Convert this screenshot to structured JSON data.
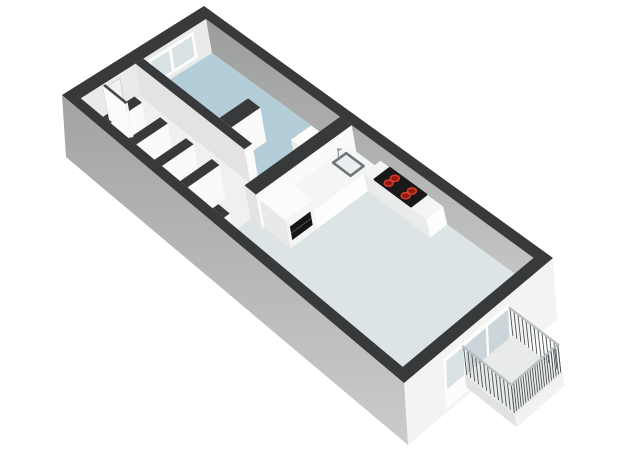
{
  "scene": {
    "type": "floorplan-3d",
    "canvas": {
      "width": 640,
      "height": 451,
      "background": "#ffffff"
    },
    "palette": {
      "wallTop": "#38393b",
      "wallFaceLit": "#fafaf9",
      "wallFaceShade": "#e3e3e1",
      "neWallTopShade": "#9b9d9d",
      "neWallBottomShade": "#c6c7c6",
      "nwWallFace": "#eaeae9",
      "extWallSW_dark": "#a2a3a3",
      "extWallSW_light": "#cbcbca",
      "extWallSE": "#f3f3f2",
      "floorBedroom": "#b3ced8",
      "floorHall": "#f0f0ee",
      "floorLiving": "#dde4e6",
      "floorBalcony": "#e9ebea",
      "glass": "#ccd5d9",
      "glassLight": "#d8e1e4",
      "frame": "#fcfcfc",
      "stoveTop": "#191919",
      "burnerFill": "#8f1a12",
      "burnerRing": "#d23a2c",
      "sinkRim": "#6f7579",
      "sinkBasin": "#eaeeee",
      "faucet": "#9aa0a2",
      "railPost": "#4e5254",
      "railTop": "#b9bec0",
      "cabinetTop": "#fbfbfa",
      "counterTop": "#f4f6f5",
      "ovenBlack": "#151515",
      "doorPanel": "#f1f1ef",
      "doorEdge": "#cfcfcd",
      "unitTop": "#fcfcfb"
    },
    "projection": {
      "corners": {
        "N": [
          204,
          6
        ],
        "E": [
          553,
          258
        ],
        "S": [
          404,
          383
        ],
        "W": [
          62,
          95
        ]
      },
      "floorDrop": [
        6,
        34
      ],
      "groundDrop": [
        4,
        62
      ],
      "exteriorThicknessA": 0.03,
      "exteriorThicknessB": 0.06
    },
    "rooms": [
      {
        "name": "bedroom",
        "floorColorKey": "floorBedroom",
        "rect": {
          "a1": 0.03,
          "a2": 0.448,
          "b1": 0.06,
          "b2": 0.555
        }
      },
      {
        "name": "hallway-with-closets",
        "floorColorKey": "floorHall",
        "rect": {
          "a1": 0.03,
          "a2": 0.448,
          "b1": 0.5,
          "b2": 0.94
        }
      },
      {
        "name": "living-room-kitchen",
        "floorColorKey": "floorLiving",
        "rect": {
          "a1": 0.415,
          "a2": 0.97,
          "b1": 0.06,
          "b2": 0.94
        }
      },
      {
        "name": "balcony",
        "floorColorKey": "floorBalcony",
        "rect": {
          "a1": 1.0,
          "a2": 1.145,
          "b1": 0.3,
          "b2": 0.62
        }
      }
    ],
    "interiorWalls": [
      {
        "name": "bedroom-alcove-stub",
        "a1": 0.25,
        "a2": 0.285,
        "b1": 0.3,
        "b2": 0.5
      },
      {
        "name": "bedroom-hall-wall",
        "a1": 0.03,
        "a2": 0.345,
        "b1": 0.5,
        "b2": 0.555
      },
      {
        "name": "bedroom-hall-wall-end",
        "a1": 0.42,
        "a2": 0.448,
        "b1": 0.5,
        "b2": 0.555
      },
      {
        "name": "closet-divider-1",
        "a1": 0.095,
        "a2": 0.117,
        "b1": 0.72,
        "b2": 0.94
      },
      {
        "name": "closet-divider-2",
        "a1": 0.17,
        "a2": 0.192,
        "b1": 0.72,
        "b2": 0.94
      },
      {
        "name": "closet-divider-3",
        "a1": 0.245,
        "a2": 0.267,
        "b1": 0.72,
        "b2": 0.94
      },
      {
        "name": "closet-divider-4",
        "a1": 0.32,
        "a2": 0.342,
        "b1": 0.72,
        "b2": 0.94
      },
      {
        "name": "living-room-wall",
        "a1": 0.415,
        "a2": 0.448,
        "b1": 0.06,
        "b2": 0.72
      },
      {
        "name": "living-room-wall-end",
        "a1": 0.415,
        "a2": 0.448,
        "b1": 0.9,
        "b2": 0.94
      }
    ],
    "openings": {
      "bedroomWindow": {
        "b1": 0.155,
        "b2": 0.475,
        "panes": [
          [
            0.175,
            0.315
          ],
          [
            0.335,
            0.455
          ]
        ]
      },
      "entranceDoor": {
        "b1": 0.672,
        "b2": 0.788,
        "leaf": {
          "a1": 0.033,
          "a2": 0.098,
          "b1": 0.775,
          "b2": 0.791
        }
      },
      "patioGlazing": {
        "frame": [
          0.3,
          0.745
        ],
        "doorPanes": [
          [
            0.315,
            0.45
          ],
          [
            0.465,
            0.6
          ]
        ],
        "windowPane": [
          0.615,
          0.73
        ]
      },
      "hallToLivingDoorway": {
        "b1": 0.72,
        "b2": 0.9
      },
      "bedroomDoorway": {
        "a1": 0.345,
        "a2": 0.42
      }
    },
    "kitchen": {
      "tallCabinet": {
        "a1": 0.45,
        "a2": 0.525,
        "b1": 0.52,
        "b2": 0.705,
        "top": [
          1,
          6
        ]
      },
      "ovenFront": {
        "b1": 0.545,
        "b2": 0.685,
        "s1": 0.3,
        "s2": 0.78
      },
      "counterSink": {
        "a1": 0.45,
        "a2": 0.525,
        "b1": 0.1,
        "b2": 0.52,
        "top": [
          2,
          16
        ]
      },
      "counterStove": {
        "a1": 0.525,
        "a2": 0.705,
        "b1": 0.06,
        "b2": 0.175,
        "top": [
          2,
          16
        ]
      },
      "sink": {
        "a1": 0.462,
        "a2": 0.512,
        "b1": 0.145,
        "b2": 0.235
      },
      "faucet": {
        "a": 0.458,
        "b": 0.19
      },
      "stove": {
        "a1": 0.555,
        "a2": 0.658,
        "b1": 0.068,
        "b2": 0.168,
        "burners": [
          [
            0.582,
            0.098
          ],
          [
            0.582,
            0.14
          ],
          [
            0.631,
            0.098
          ],
          [
            0.631,
            0.14
          ]
        ]
      }
    },
    "bedroomUnit": {
      "a1": 0.37,
      "a2": 0.413,
      "b1": 0.16,
      "b2": 0.3,
      "top": [
        1,
        10
      ]
    },
    "balconyRailing": {
      "postsLong": 20,
      "postsShort": 12,
      "topOffset": [
        1,
        11
      ],
      "baseOffset": [
        4,
        39
      ]
    }
  }
}
